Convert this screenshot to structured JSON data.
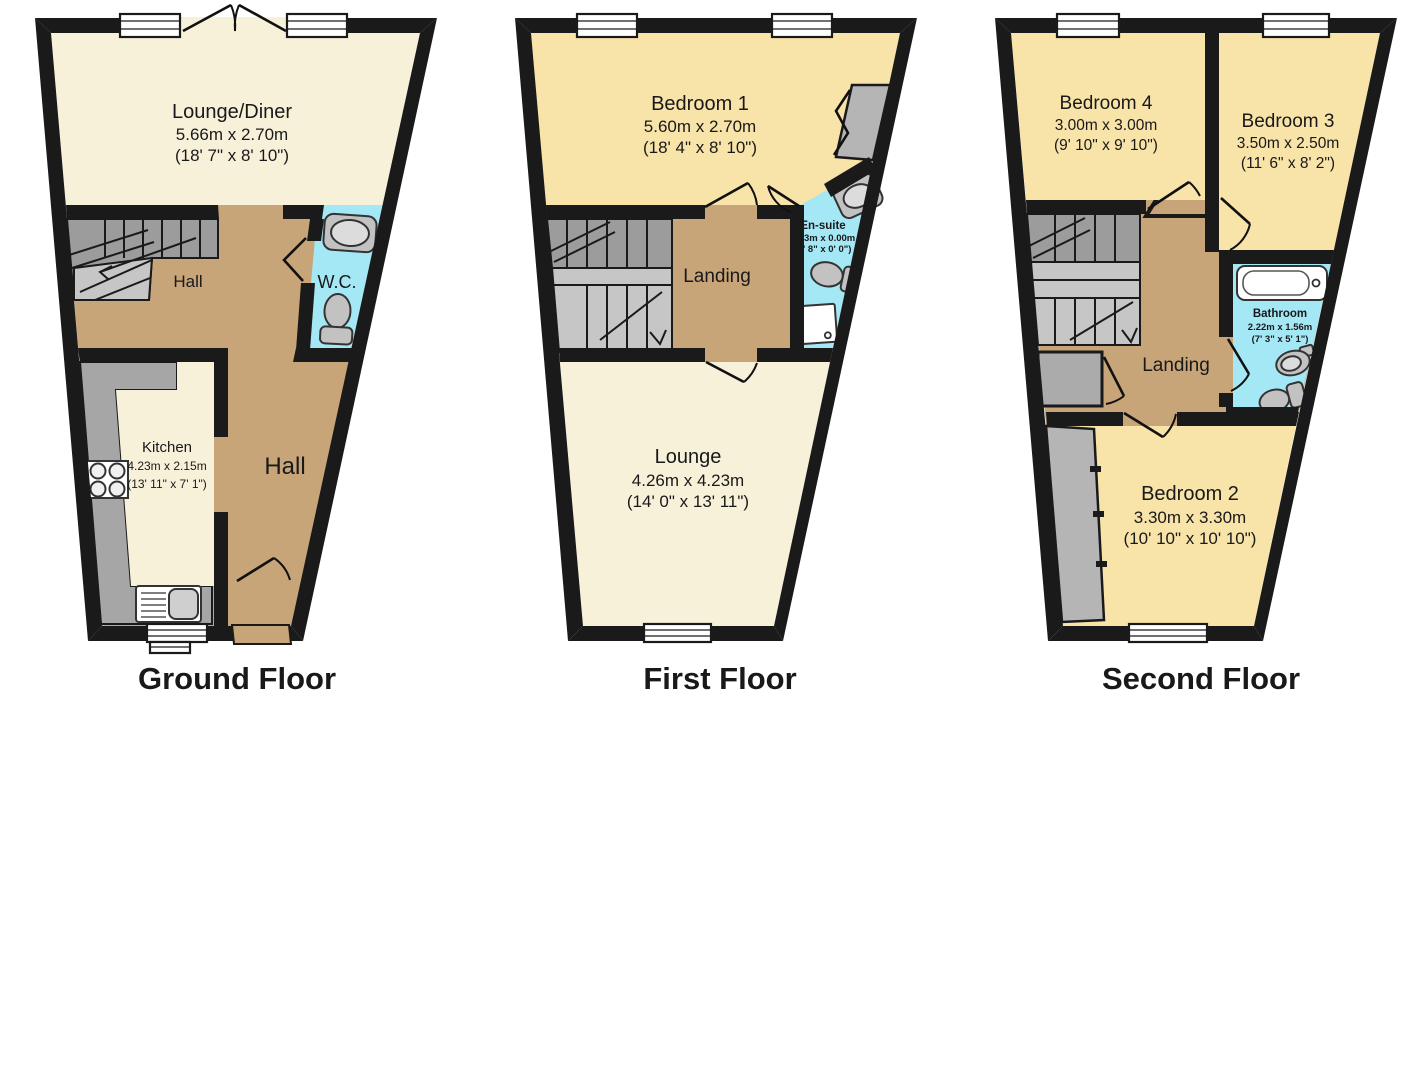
{
  "colors": {
    "walls": "#1a1a1a",
    "lounge": "#f8f1da",
    "bedroom": "#f8e3a8",
    "hall": "#c7a578",
    "bathroom": "#a5e8f5",
    "stairsDark": "#9c9c9c",
    "stairsLight": "#c6c6c6",
    "counter": "#a6a6a6",
    "fixture": "#c2c2c2"
  },
  "floors": [
    {
      "caption": "Ground Floor",
      "fixtures": [
        "wc-sink",
        "wc-toilet",
        "kitchen-hob",
        "kitchen-sink",
        "stairs"
      ],
      "rooms": [
        {
          "name": "Lounge/Diner",
          "dims_m": "5.66m x 2.70m",
          "dims_ft": "(18' 7\" x 8' 10\")"
        },
        {
          "name": "Hall"
        },
        {
          "name": "W.C."
        },
        {
          "name": "Kitchen",
          "dims_m": "4.23m x 2.15m",
          "dims_ft": "(13' 11\" x 7' 1\")"
        },
        {
          "name": "Hall"
        }
      ]
    },
    {
      "caption": "First Floor",
      "fixtures": [
        "ensuite-sink",
        "ensuite-toilet",
        "shower-tray",
        "wardrobe",
        "stairs"
      ],
      "rooms": [
        {
          "name": "Bedroom 1",
          "dims_m": "5.60m x 2.70m",
          "dims_ft": "(18' 4\" x 8' 10\")"
        },
        {
          "name": "En-suite",
          "dims_m": "1.13m x 0.00m",
          "dims_ft": "(3' 8\" x 0' 0\")"
        },
        {
          "name": "Landing"
        },
        {
          "name": "Lounge",
          "dims_m": "4.26m x 4.23m",
          "dims_ft": "(14' 0\" x 13' 11\")"
        }
      ]
    },
    {
      "caption": "Second Floor",
      "fixtures": [
        "bath",
        "bathroom-sink",
        "bathroom-toilet",
        "stairs",
        "eaves-storage"
      ],
      "rooms": [
        {
          "name": "Bedroom 4",
          "dims_m": "3.00m x 3.00m",
          "dims_ft": "(9' 10\" x 9' 10\")"
        },
        {
          "name": "Bedroom 3",
          "dims_m": "3.50m x 2.50m",
          "dims_ft": "(11' 6\" x 8' 2\")"
        },
        {
          "name": "Bathroom",
          "dims_m": "2.22m x 1.56m",
          "dims_ft": "(7' 3\" x 5' 1\")"
        },
        {
          "name": "Landing"
        },
        {
          "name": "Bedroom 2",
          "dims_m": "3.30m x 3.30m",
          "dims_ft": "(10' 10\" x 10' 10\")"
        }
      ]
    }
  ]
}
